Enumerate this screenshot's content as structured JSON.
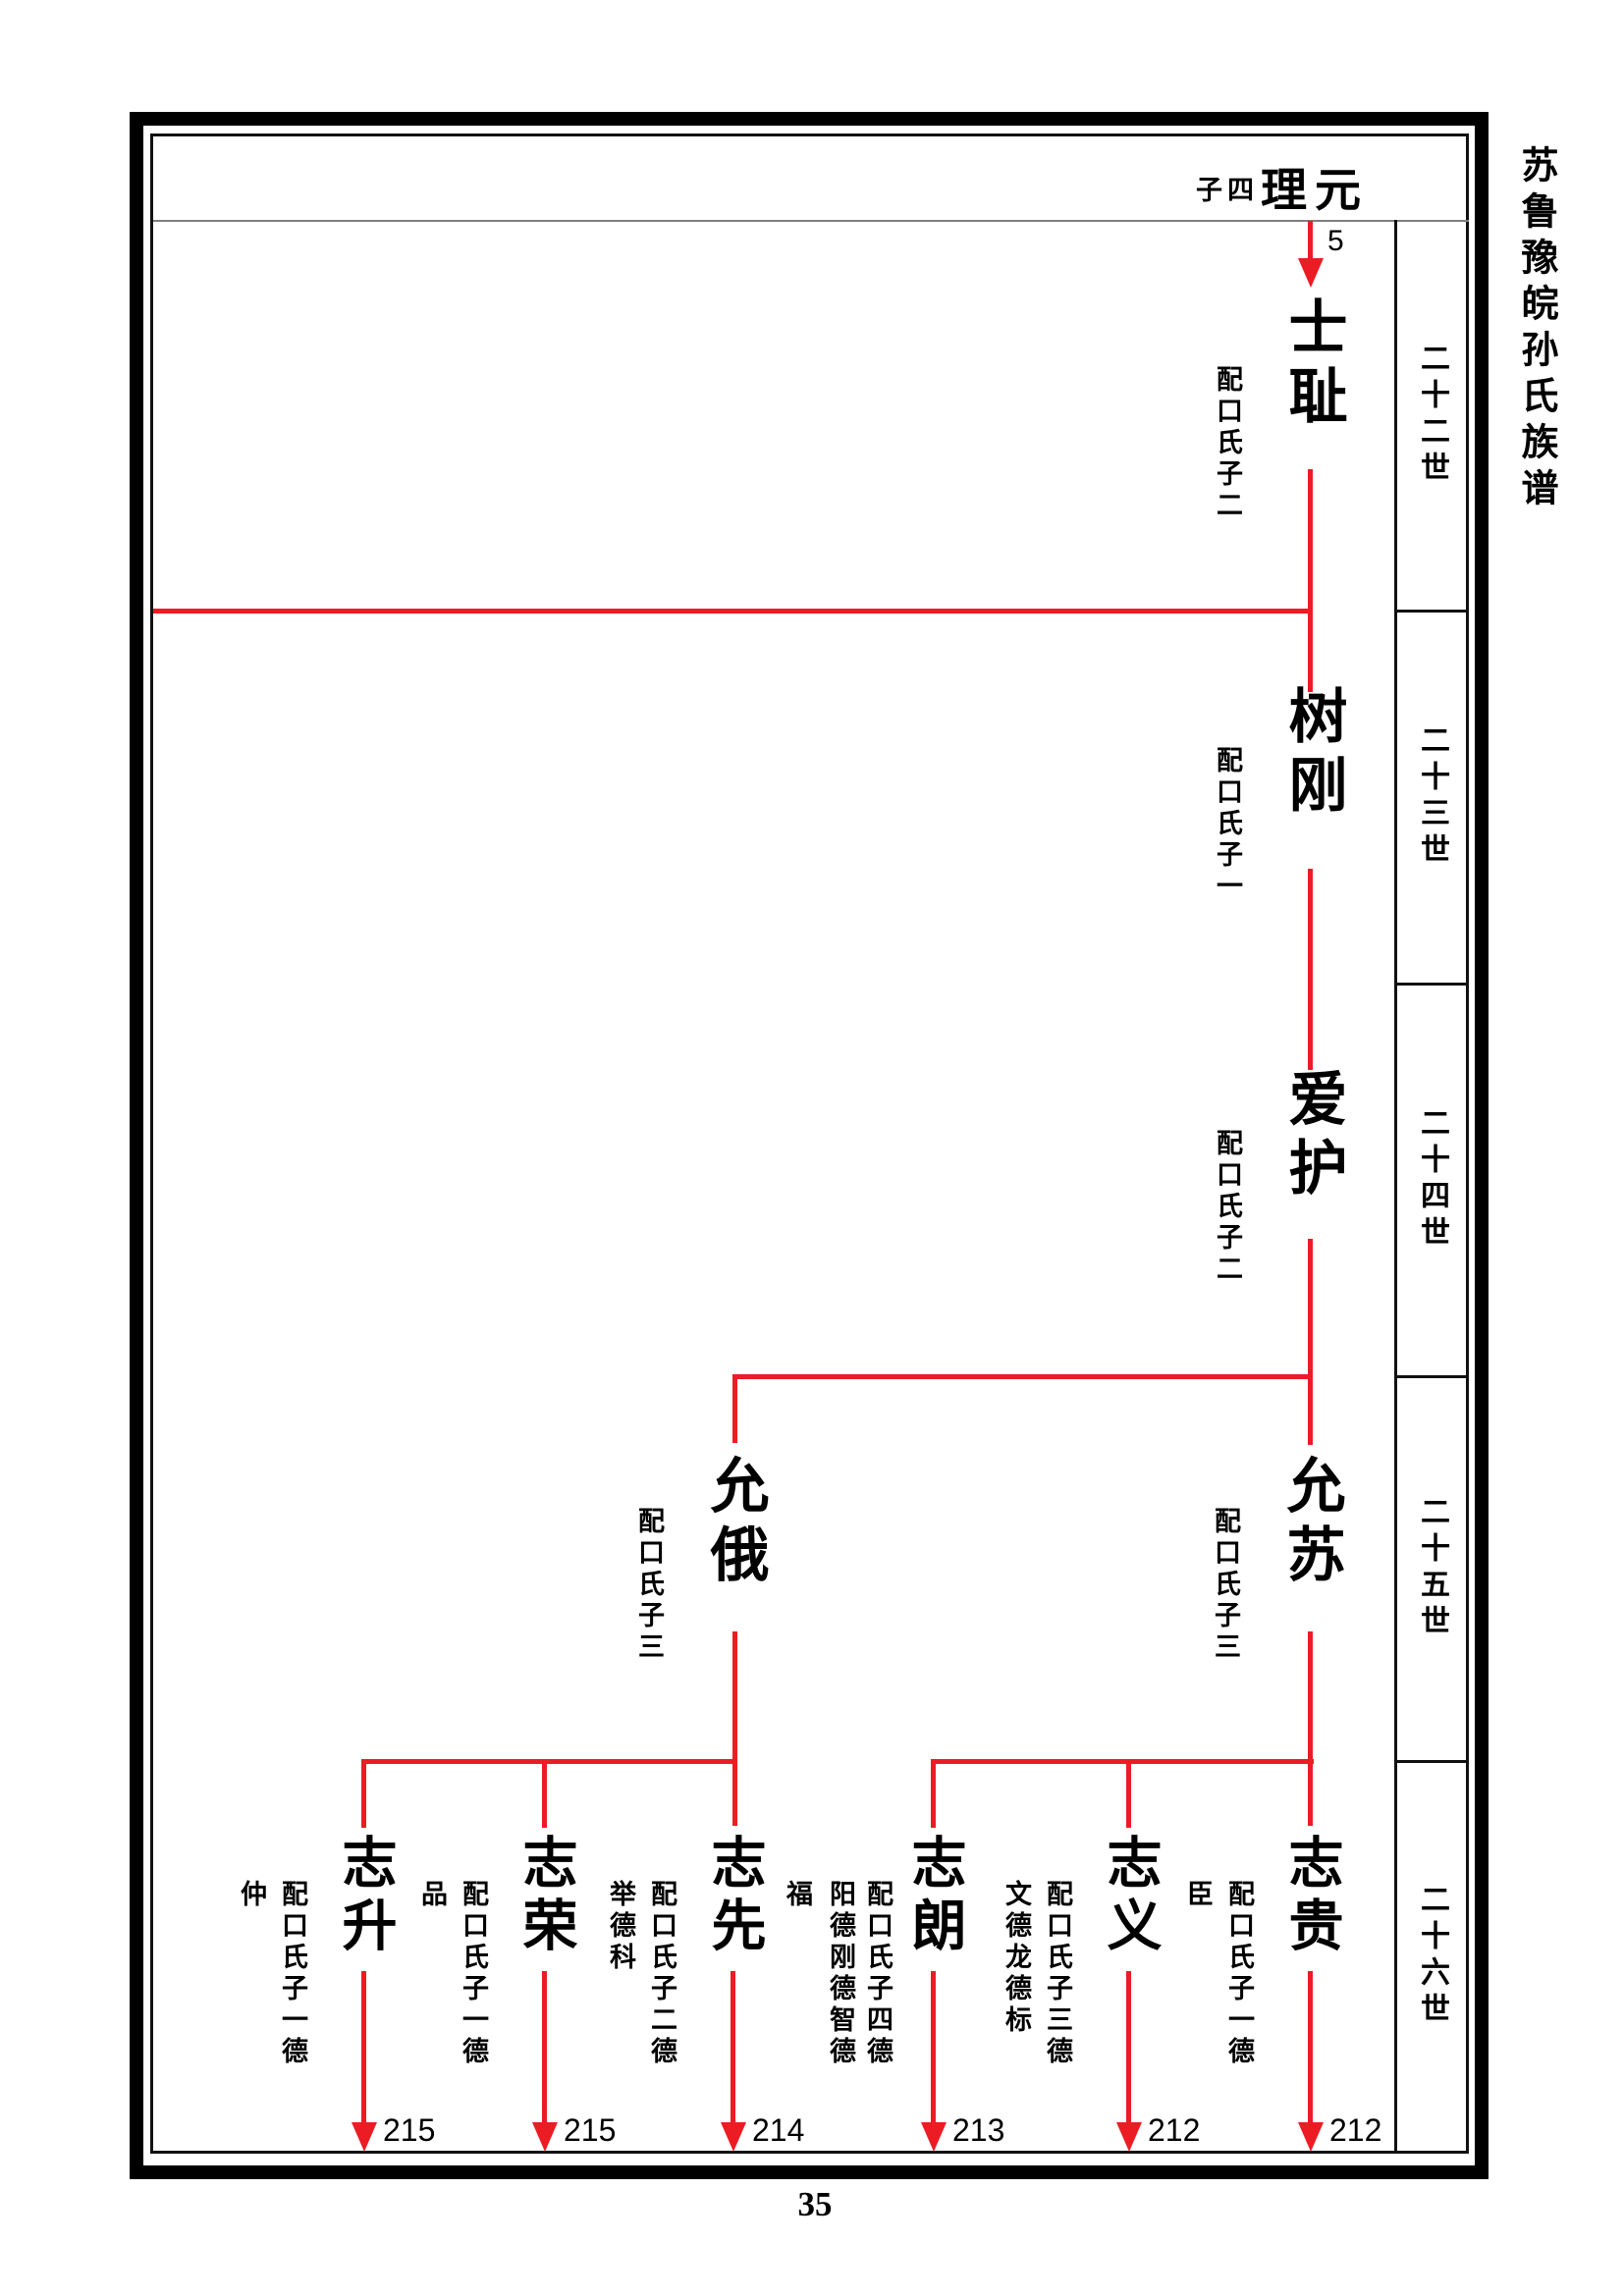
{
  "page_number": "35",
  "book_title": "苏鲁豫皖孙氏族谱",
  "header": {
    "note": "子四",
    "name": "理元",
    "continuation_ref": "5"
  },
  "generation_labels": [
    "二十二世",
    "二十三世",
    "二十四世",
    "二十五世",
    "二十六世"
  ],
  "colors": {
    "line_red": "#ec1c24"
  },
  "tree": {
    "g22": {
      "name": "士耻",
      "spouse": "配口氏子二"
    },
    "g23": {
      "name": "树刚",
      "spouse": "配口氏子一"
    },
    "g24": {
      "name": "爱护",
      "spouse": "配口氏子二"
    },
    "g25_left": {
      "name": "允俄",
      "spouse": "配口氏子三"
    },
    "g25_right": {
      "name": "允苏",
      "spouse": "配口氏子三"
    },
    "g26": [
      {
        "name": "志升",
        "note1": "配口氏子一德",
        "note2": "仲",
        "ref": "215"
      },
      {
        "name": "志荣",
        "note1": "配口氏子一德",
        "note2": "品",
        "ref": "215"
      },
      {
        "name": "志先",
        "note1": "配口氏子二德",
        "note2": "举德科",
        "ref": "214"
      },
      {
        "name": "志朗",
        "note1": "配口氏子四德",
        "note2": "阳德刚德智德",
        "note3": "福",
        "ref": "213"
      },
      {
        "name": "志义",
        "note1": "配口氏子三德",
        "note2": "文德龙德标",
        "ref": "212"
      },
      {
        "name": "志贵",
        "note1": "配口氏子一德",
        "note2": "臣",
        "ref": "212"
      }
    ]
  }
}
